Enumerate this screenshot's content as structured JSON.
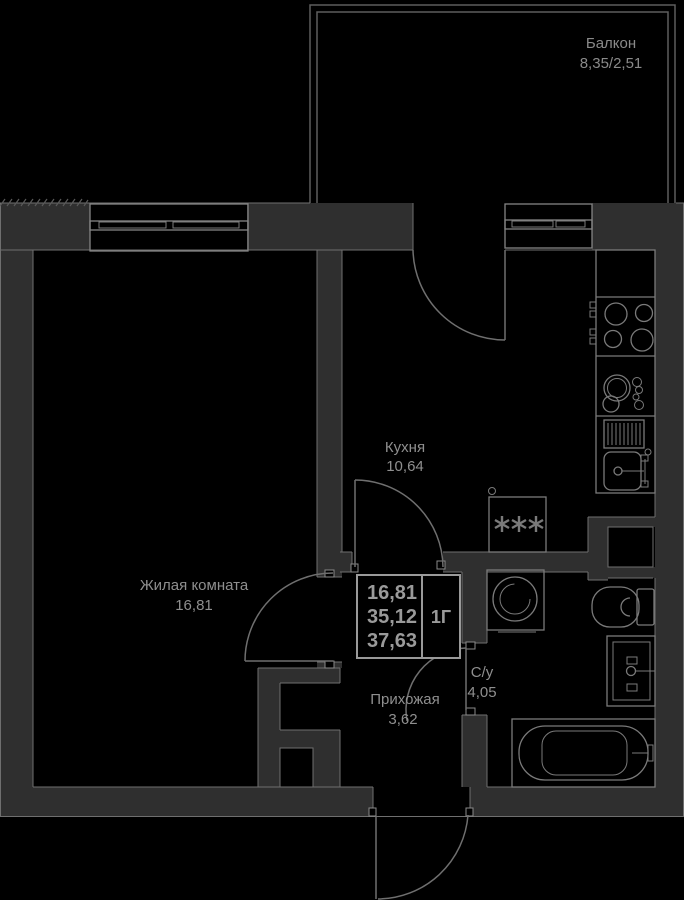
{
  "floor_plan": {
    "rooms": [
      {
        "name": "Балкон",
        "area": "8,35/2,51"
      },
      {
        "name": "Кухня",
        "area": "10,64"
      },
      {
        "name": "Жилая комната",
        "area": "16,81"
      },
      {
        "name": "Прихожая",
        "area": "3,62"
      },
      {
        "name": "С/у",
        "area": "4,05"
      }
    ],
    "info_box": {
      "values": [
        "16,81",
        "35,12",
        "37,63"
      ],
      "unit_label": "1Г"
    },
    "fixtures": [
      "stove",
      "kitchen-sink",
      "drying-rack",
      "fridge",
      "washing-machine",
      "toilet",
      "bathroom-sink",
      "bathtub"
    ],
    "colors": {
      "background": "#000000",
      "wall": "#2f2f2f",
      "line": "#6f6f6f",
      "text": "#8f8f8f"
    }
  }
}
